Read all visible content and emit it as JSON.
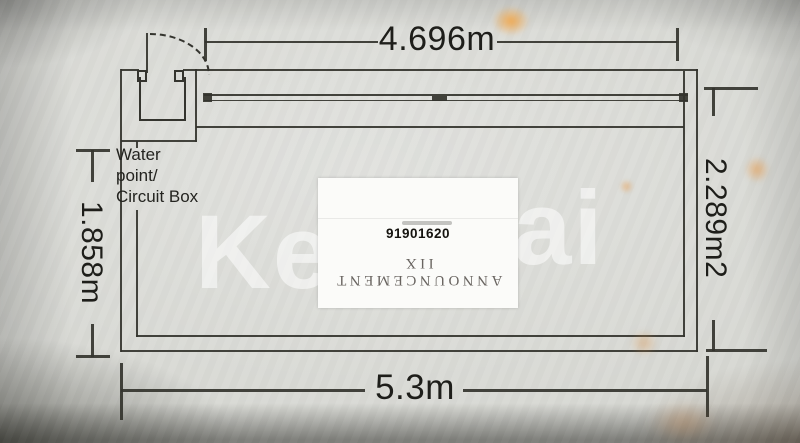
{
  "watermark": {
    "left": "Ke",
    "right": "ai"
  },
  "dimensions": {
    "top": "4.696m",
    "bottom": "5.3m",
    "left": "1.858m",
    "right": "2.289m2"
  },
  "labels": {
    "water_point": [
      "Water",
      "point/",
      "Circuit Box"
    ]
  },
  "sticker": {
    "number": "91901620",
    "upside_down_text": "ANNOUNCEMENT IIX"
  },
  "colors": {
    "paper": "#d6d7d2",
    "line": "#34342e",
    "text": "#1e1e1a",
    "watermark": "#ffffff",
    "sticker-bg": "#fbfbf9",
    "reflection-orange": "#efa852"
  }
}
